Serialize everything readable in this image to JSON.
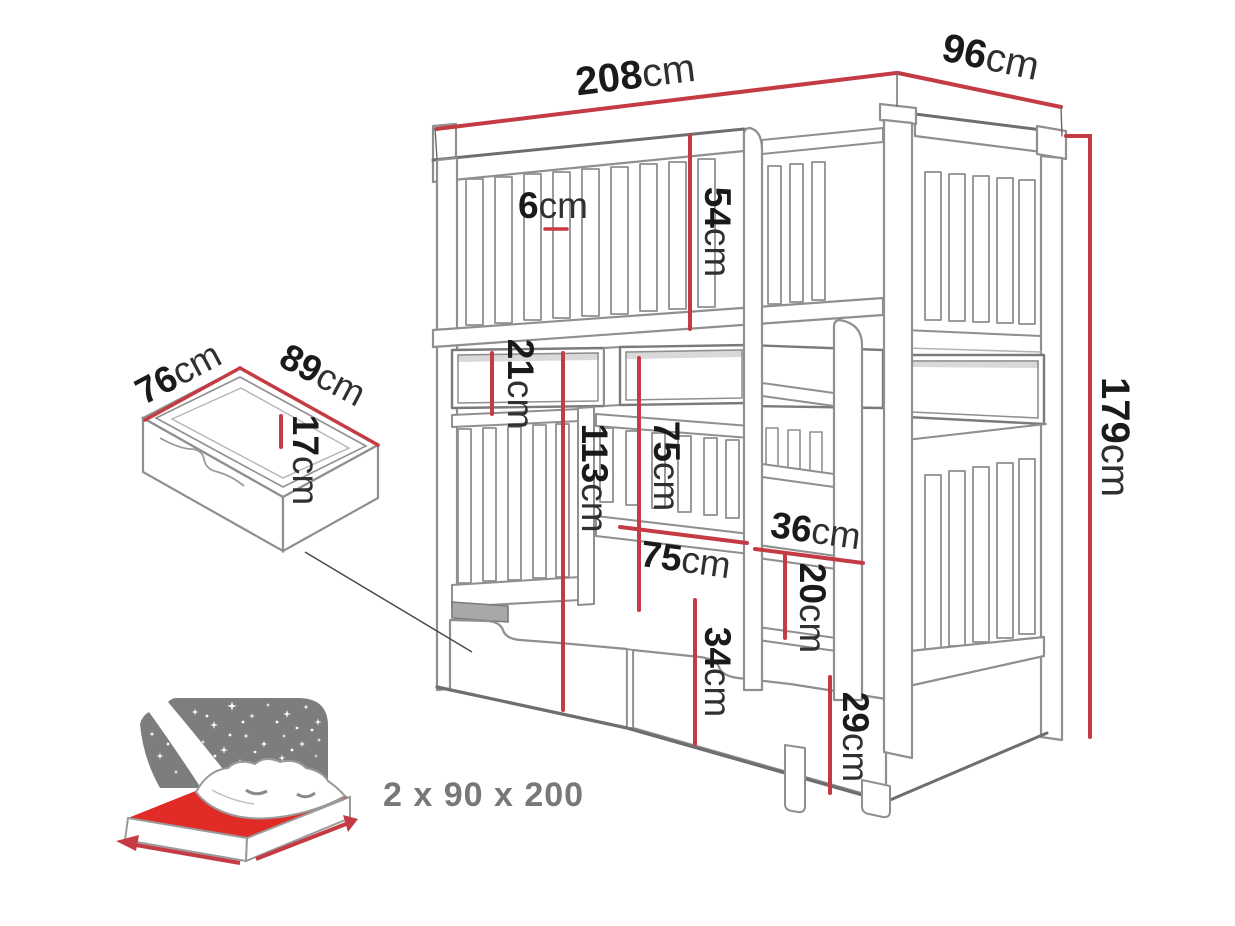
{
  "title": "Bunk bed with storage drawer - dimensions diagram",
  "bed": {
    "width": {
      "value": "208",
      "unit": "cm"
    },
    "depth": {
      "value": "96",
      "unit": "cm"
    },
    "height": {
      "value": "179",
      "unit": "cm"
    },
    "upper_guard_height": {
      "value": "54",
      "unit": "cm"
    },
    "slat_gap": {
      "value": "6",
      "unit": "cm"
    },
    "bunk_gap": {
      "value": "21",
      "unit": "cm"
    },
    "lower_guard_top": {
      "value": "113",
      "unit": "cm"
    },
    "entry_height": {
      "value": "75",
      "unit": "cm"
    },
    "entry_width": {
      "value": "75",
      "unit": "cm"
    },
    "ladder_width": {
      "value": "36",
      "unit": "cm"
    },
    "rung_spacing": {
      "value": "20",
      "unit": "cm"
    },
    "drawer_front_height": {
      "value": "34",
      "unit": "cm"
    },
    "base_height": {
      "value": "29",
      "unit": "cm"
    }
  },
  "storage_drawer": {
    "depth": {
      "value": "76",
      "unit": "cm"
    },
    "width": {
      "value": "89",
      "unit": "cm"
    },
    "height": {
      "value": "17",
      "unit": "cm"
    }
  },
  "mattress": {
    "size_label": "2 x 90 x 200"
  },
  "colors": {
    "dimension_red": "#c43b44",
    "mattress_red": "#e12b26",
    "outline_gray": "#8f8f8f",
    "dark_gray": "#6e6e6e",
    "panel_gray": "#7d7d7d",
    "text_black": "#1a1a1a",
    "muted_gray": "#787878"
  }
}
